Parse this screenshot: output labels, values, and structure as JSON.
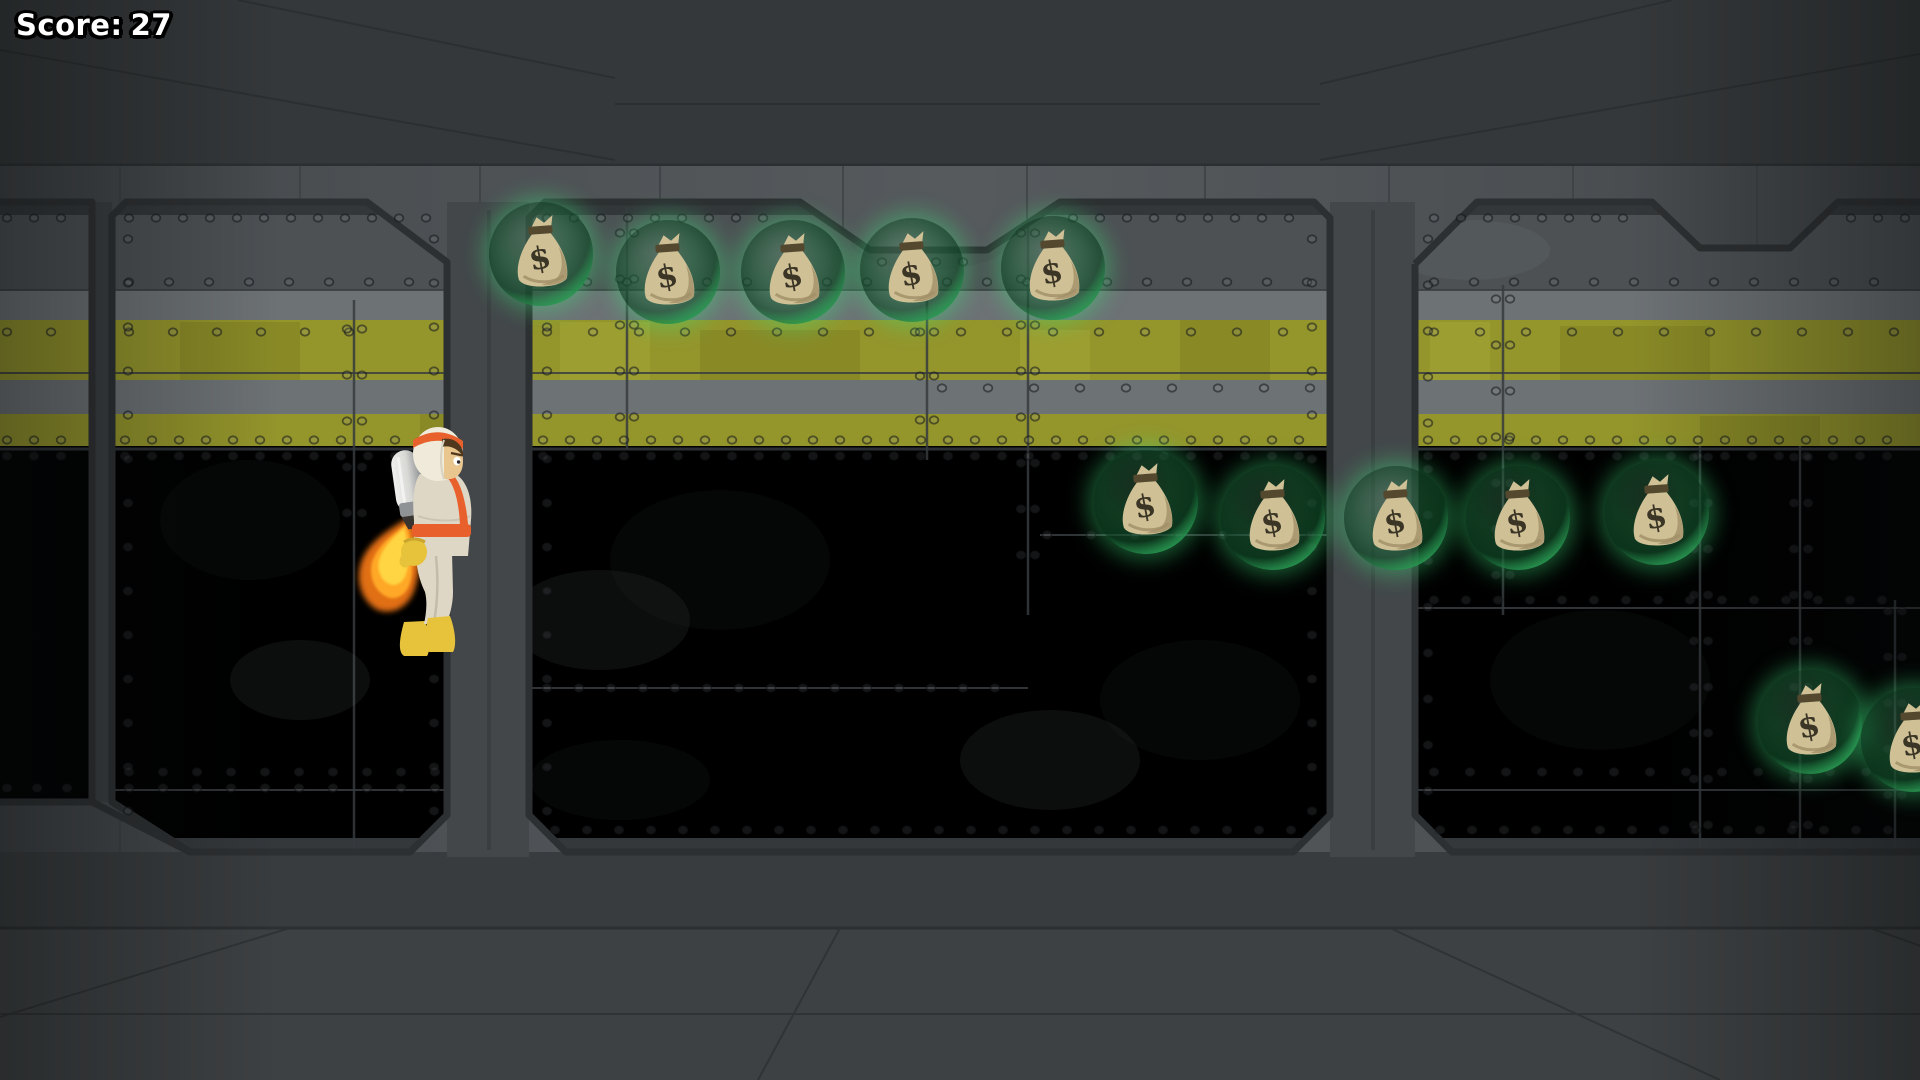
{
  "hud": {
    "score_label": "Score:",
    "score_value": "27"
  },
  "player": {
    "type": "jetpack-astronaut",
    "facing": "right",
    "state": "flying-with-thrust",
    "x": 350,
    "y": 424,
    "width": 145,
    "height": 240,
    "colors": {
      "suit": "#ded7c6",
      "suit_shade": "#c3bca9",
      "trim": "#e8602c",
      "helmet": "#efead9",
      "skin": "#eac68f",
      "hair": "#4e3односторонній0f1f",
      "gloves_boots": "#e7c33c",
      "jetpack_light": "#f1f1ef",
      "jetpack_dark": "#909395",
      "nozzle": "#3a3430",
      "flame_core": "#ffd844",
      "flame_mid": "#ffa726",
      "flame_outer": "#ee7416"
    }
  },
  "coins": {
    "kind": "money-bag-in-bubble",
    "symbol": "$",
    "radius": 52,
    "colors": {
      "bubble_rim": "#46e07c",
      "bag": "#cfc096",
      "bag_shade": "#a08f66",
      "bag_tie": "#54492e",
      "symbol_color": "#3b3526"
    },
    "items": [
      {
        "x": 541,
        "y": 254
      },
      {
        "x": 668,
        "y": 272
      },
      {
        "x": 793,
        "y": 272
      },
      {
        "x": 912,
        "y": 270
      },
      {
        "x": 1053,
        "y": 268
      },
      {
        "x": 1146,
        "y": 502
      },
      {
        "x": 1273,
        "y": 518
      },
      {
        "x": 1396,
        "y": 518
      },
      {
        "x": 1518,
        "y": 518
      },
      {
        "x": 1657,
        "y": 513
      },
      {
        "x": 1810,
        "y": 722
      },
      {
        "x": 1913,
        "y": 740
      }
    ]
  },
  "environment": {
    "setting": "industrial-metal-corridor",
    "hazard_stripe_color": "#94952b",
    "wall_color": "#565a5d",
    "outline_color": "#2d3032"
  }
}
